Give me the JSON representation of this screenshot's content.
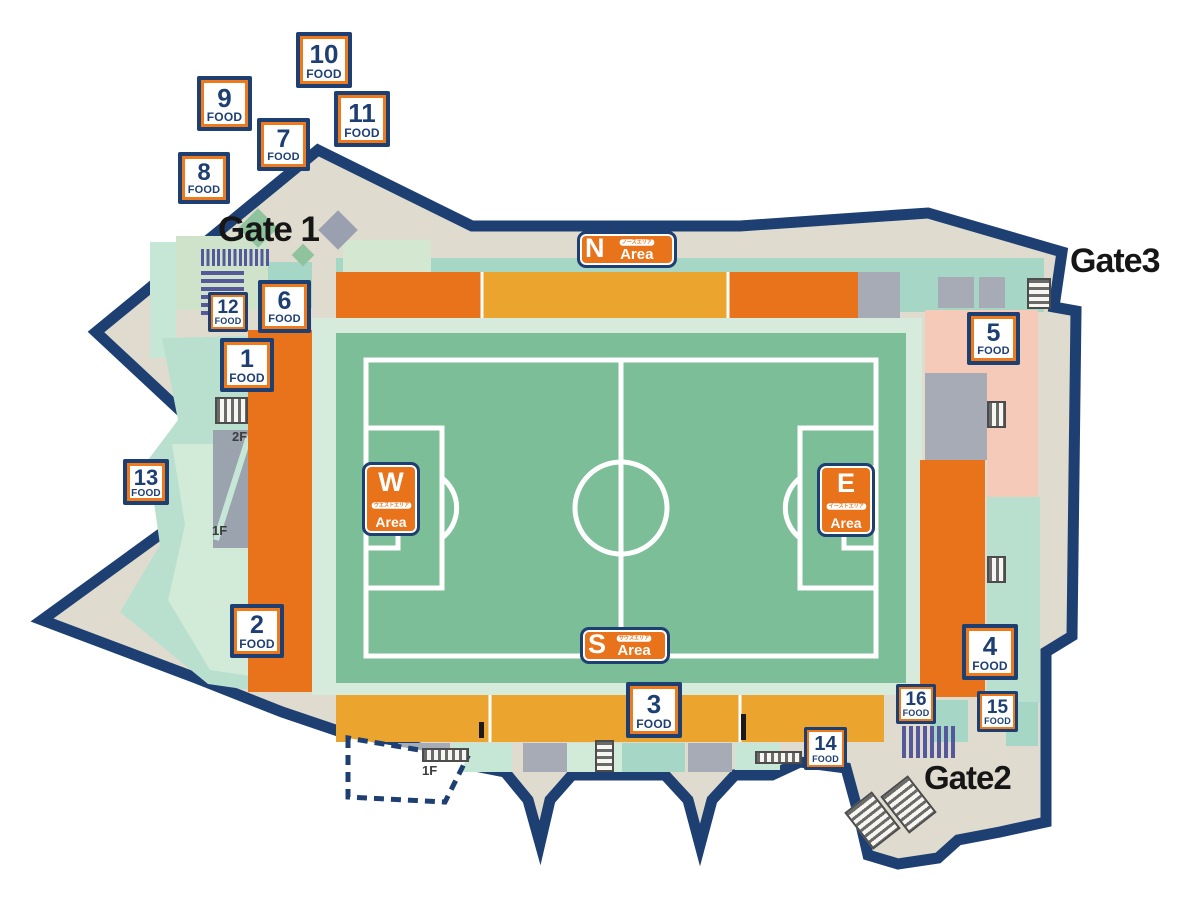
{
  "map": {
    "gates": [
      {
        "id": "gate1",
        "label": "Gate 1"
      },
      {
        "id": "gate2",
        "label": "Gate2"
      },
      {
        "id": "gate3",
        "label": "Gate3"
      }
    ],
    "areas": {
      "north": {
        "letter": "N",
        "word": "Area",
        "kana": "ノースエリア"
      },
      "south": {
        "letter": "S",
        "word": "Area",
        "kana": "サウスエリア"
      },
      "west": {
        "letter": "W",
        "word": "Area",
        "kana": "ウエストエリア"
      },
      "east": {
        "letter": "E",
        "word": "Area",
        "kana": "イーストエリア"
      }
    },
    "food_label": "FOOD",
    "food_stalls": [
      {
        "num": "1",
        "x": 220,
        "y": 338,
        "size": 54
      },
      {
        "num": "2",
        "x": 230,
        "y": 604,
        "size": 54
      },
      {
        "num": "3",
        "x": 626,
        "y": 682,
        "size": 56
      },
      {
        "num": "4",
        "x": 962,
        "y": 624,
        "size": 56
      },
      {
        "num": "5",
        "x": 967,
        "y": 312,
        "size": 53
      },
      {
        "num": "6",
        "x": 258,
        "y": 280,
        "size": 53
      },
      {
        "num": "7",
        "x": 257,
        "y": 118,
        "size": 53
      },
      {
        "num": "8",
        "x": 178,
        "y": 152,
        "size": 52
      },
      {
        "num": "9",
        "x": 197,
        "y": 76,
        "size": 55
      },
      {
        "num": "10",
        "x": 296,
        "y": 32,
        "size": 56
      },
      {
        "num": "11",
        "x": 334,
        "y": 91,
        "size": 56
      },
      {
        "num": "12",
        "x": 208,
        "y": 292,
        "size": 40
      },
      {
        "num": "13",
        "x": 123,
        "y": 459,
        "size": 46
      },
      {
        "num": "14",
        "x": 804,
        "y": 727,
        "size": 43
      },
      {
        "num": "15",
        "x": 977,
        "y": 691,
        "size": 41
      },
      {
        "num": "16",
        "x": 896,
        "y": 684,
        "size": 40
      }
    ],
    "floor_labels": [
      {
        "text": "2F"
      },
      {
        "text": "1F"
      },
      {
        "text": "1F"
      }
    ],
    "colors": {
      "navy": "#1e3f72",
      "stand_orange": "#e8731b",
      "stand_amber": "#eba42e",
      "marker_orange": "#ee7a1c",
      "pitch_green": "#7cbe97",
      "mint": "#d7ebdc",
      "teal": "#a6d7c6",
      "concourse_beige": "#dfdbce",
      "gray_block": "#a7abb5",
      "pink": "#f6cab8",
      "turnstile_indigo": "#56589c"
    }
  }
}
